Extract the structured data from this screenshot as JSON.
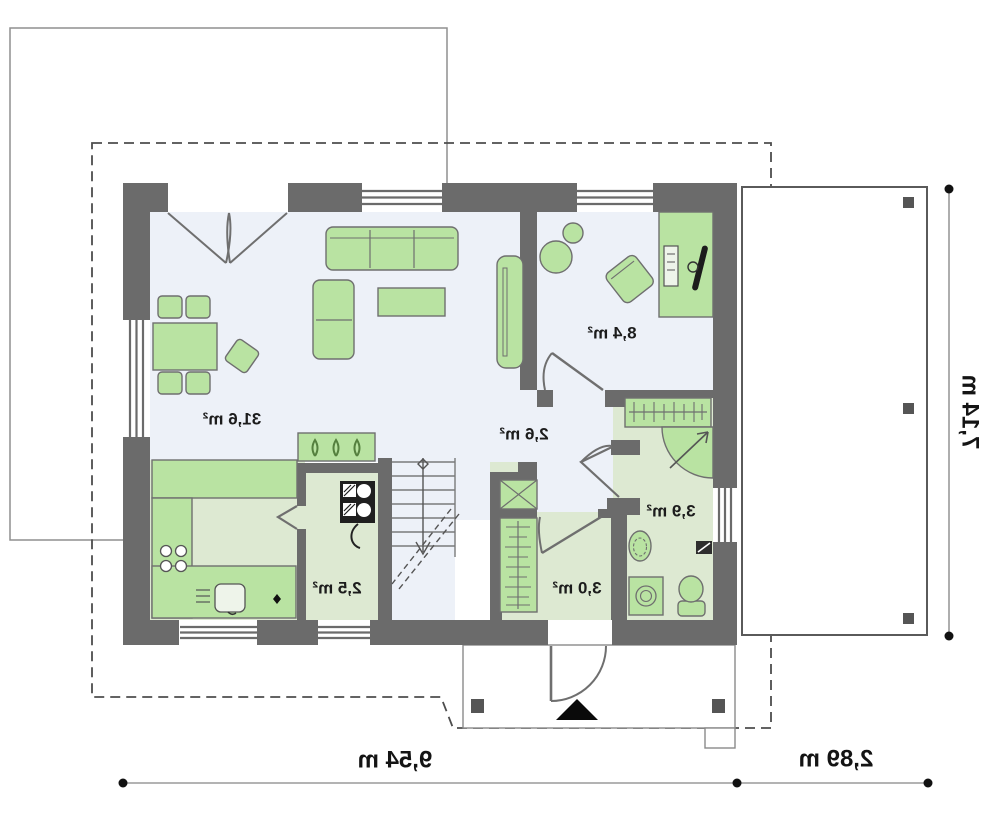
{
  "plan": {
    "type": "house-floor-plan",
    "mirrored": true,
    "rooms": [
      {
        "name": "living-dining-room",
        "area": "31,6 m²"
      },
      {
        "name": "boiler-room",
        "area": "2,5 m²"
      },
      {
        "name": "corridor",
        "area": "2,6 m²"
      },
      {
        "name": "vestibule-hall",
        "area": "3,0 m²"
      },
      {
        "name": "bathroom",
        "area": "3,9 m²"
      },
      {
        "name": "bedroom-office",
        "area": "8,4 m²"
      }
    ],
    "dimensions": {
      "bottom_main": "9,54 m",
      "bottom_secondary": "2,89 m",
      "right_side": "7,14 m"
    },
    "colors": {
      "wall": "#6b6b6b",
      "furniture_fill": "#b9e3a2",
      "furniture_stroke": "#6f6f6f",
      "floor_wood": "#edf1f8",
      "floor_tile": "#dde9d2",
      "entry_marker": "#0a0a0a"
    }
  }
}
